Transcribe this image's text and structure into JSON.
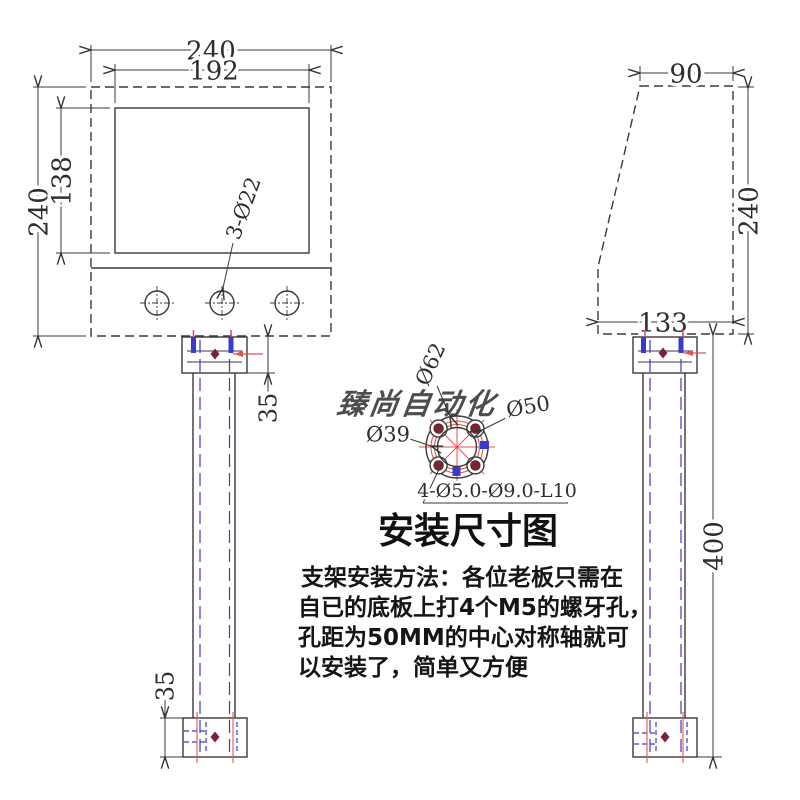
{
  "title": "安装尺寸图",
  "watermark": "臻尚自动化",
  "notes": {
    "line1": "支架安装方法：各位老板只需在",
    "line2": "自已的底板上打4个M5的螺牙孔，",
    "line3": "孔距为50MM的中心对称轴就可",
    "line4": "以安装了，简单又方便"
  },
  "front_view": {
    "overall_width": "240",
    "screen_width": "192",
    "overall_height": "240",
    "screen_height": "138",
    "button_holes": "3-Ø22",
    "top_bracket_height": "35",
    "bottom_bracket_height": "35"
  },
  "side_view": {
    "top_depth": "90",
    "height": "240",
    "bottom_depth": "133",
    "pole_length": "400"
  },
  "flange": {
    "outer_diameter": "Ø62",
    "bolt_circle_diameter": "Ø50",
    "inner_diameter": "Ø39",
    "mount_holes": "4-Ø5.0-Ø9.0-L10"
  },
  "colors": {
    "line": "#333333",
    "hidden_blue": "#3a3acc",
    "accent_red": "#e05555",
    "dark_red": "#7a2040",
    "watermark_blue": "#7cc0ee"
  }
}
